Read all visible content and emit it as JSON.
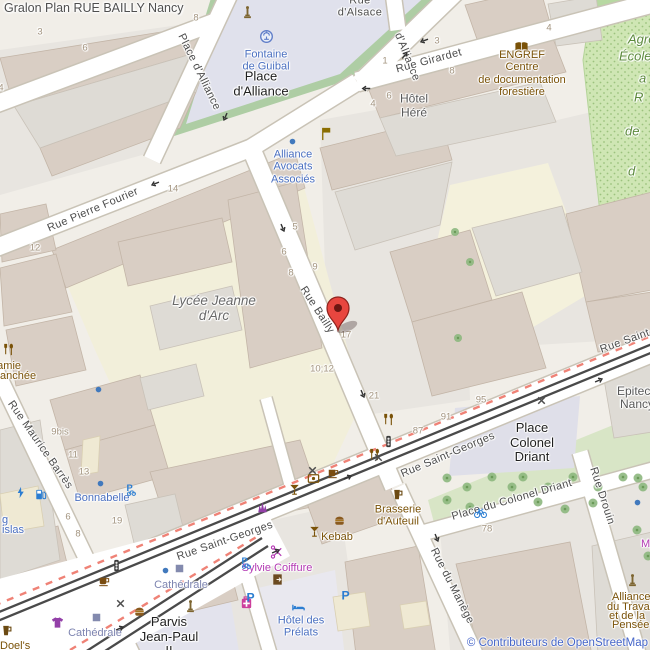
{
  "title": "Gralon Plan RUE BAILLY Nancy",
  "attribution": "© Contributeurs de OpenStreetMap",
  "colors": {
    "marker_red": "#e8463f",
    "street_label": "#4c4c4c",
    "poi_blue": "#4a6fc0",
    "poi_brown": "#7a5208",
    "shop_magenta": "#b339b3",
    "station_blue": "#7d84b0",
    "green_text": "#5c8a3c",
    "housenumber": "#a3947f",
    "attribution_blue": "#4565c8",
    "pedestrian_area": "#e0e1ec",
    "school_area": "#f2efda",
    "park_green": "#cfe6b4",
    "building_tan": "#d9cec4",
    "building_gray": "#dedbd5"
  },
  "marker": {
    "location": "Rue Bailly",
    "x": 338,
    "y": 330
  },
  "labels": [
    {
      "id": "street-place-dalliance",
      "t": "Place d'Alliance",
      "x": 199,
      "y": 72,
      "r": 64,
      "c": "st"
    },
    {
      "id": "street-dalliance",
      "t": "d'Alliance",
      "x": 407,
      "y": 57,
      "r": 68,
      "c": "st"
    },
    {
      "id": "street-rue-dalsace",
      "t": "Rue\nd'Alsace",
      "x": 360,
      "y": 7,
      "r": 0,
      "c": "st"
    },
    {
      "id": "street-rue-girardet",
      "t": "Rue Girardet",
      "x": 429,
      "y": 61,
      "r": -15,
      "c": "st"
    },
    {
      "id": "street-rue-pierre-fourier",
      "t": "Rue Pierre Fourier",
      "x": 93,
      "y": 210,
      "r": -23,
      "c": "st"
    },
    {
      "id": "street-rue-bailly",
      "t": "Rue Bailly",
      "x": 317,
      "y": 310,
      "r": 57,
      "c": "st"
    },
    {
      "id": "street-rue-saint-georges-1",
      "t": "Rue Saint-Georges",
      "x": 448,
      "y": 455,
      "r": -23,
      "c": "st"
    },
    {
      "id": "street-rue-saint-georges-2",
      "t": "Rue Saint-Georges",
      "x": 225,
      "y": 541,
      "r": -19,
      "c": "st"
    },
    {
      "id": "street-rue-saint-georges-3",
      "t": "Rue Saint-Georges",
      "x": 648,
      "y": 333,
      "r": -20,
      "c": "st"
    },
    {
      "id": "street-rue-maurice-barres",
      "t": "Rue Maurice Barrès",
      "x": 40,
      "y": 445,
      "r": 55,
      "c": "st"
    },
    {
      "id": "street-place-du-colonel-driant",
      "t": "Place du Colonel Driant",
      "x": 512,
      "y": 500,
      "r": -16,
      "c": "st"
    },
    {
      "id": "street-rue-drouin",
      "t": "Rue Drouin",
      "x": 602,
      "y": 496,
      "r": 72,
      "c": "st"
    },
    {
      "id": "street-rue-du-manege",
      "t": "Rue du Manège",
      "x": 452,
      "y": 586,
      "r": 63,
      "c": "st"
    },
    {
      "id": "place-dalliance-label",
      "t": "Place\nd'Alliance",
      "x": 261,
      "y": 84,
      "r": 0,
      "c": "place"
    },
    {
      "id": "place-colonel-driant-label",
      "t": "Place\nColonel\nDriant",
      "x": 532,
      "y": 443,
      "r": 0,
      "c": "place"
    },
    {
      "id": "parvis-jean-paul-label",
      "t": "Parvis\nJean-Paul\nII",
      "x": 169,
      "y": 637,
      "r": 0,
      "c": "place"
    },
    {
      "id": "poi-fontaine-de-guibal",
      "t": "Fontaine\nde Guibal",
      "x": 266,
      "y": 61,
      "r": 0,
      "c": "pblue"
    },
    {
      "id": "poi-alliance-avocats",
      "t": "Alliance\nAvocats\nAssociés",
      "x": 293,
      "y": 167,
      "r": 0,
      "c": "pblue"
    },
    {
      "id": "poi-bonnabelle",
      "t": "Bonnabelle",
      "x": 102,
      "y": 498,
      "r": 0,
      "c": "pblue"
    },
    {
      "id": "poi-hotel-des-prelats",
      "t": "Hôtel des\nPrélats",
      "x": 301,
      "y": 627,
      "r": 0,
      "c": "pblue"
    },
    {
      "id": "poi-parking-fragment-1",
      "t": "g",
      "x": 2,
      "y": 520,
      "r": 0,
      "c": "pblue",
      "a": "l"
    },
    {
      "id": "poi-parking-fragment-2",
      "t": "islas",
      "x": 2,
      "y": 530,
      "r": 0,
      "c": "pblue",
      "a": "l"
    },
    {
      "id": "station-cathedrale-1",
      "t": "Cathédrale",
      "x": 181,
      "y": 585,
      "r": 0,
      "c": "stat"
    },
    {
      "id": "station-cathedrale-2",
      "t": "Cathédrale",
      "x": 95,
      "y": 633,
      "r": 0,
      "c": "stat"
    },
    {
      "id": "poi-engref",
      "t": "ENGREF\nCentre\nde documentation\nforestière",
      "x": 522,
      "y": 74,
      "r": 0,
      "c": "pbrown"
    },
    {
      "id": "poi-brasserie-dauteuil",
      "t": "Brasserie\nd'Auteuil",
      "x": 398,
      "y": 516,
      "r": 0,
      "c": "pbrown"
    },
    {
      "id": "poi-kebab",
      "t": "Kebab",
      "x": 337,
      "y": 537,
      "r": 0,
      "c": "pbrown"
    },
    {
      "id": "poi-mamie-fragment-1",
      "t": "Mamie",
      "x": -12,
      "y": 366,
      "r": 0,
      "c": "pbrown",
      "a": "l"
    },
    {
      "id": "poi-mamie-fragment-2",
      "t": "anchée",
      "x": 0,
      "y": 376,
      "r": 0,
      "c": "pbrown",
      "a": "l"
    },
    {
      "id": "poi-alliance-travail-1",
      "t": "Alliance",
      "x": 612,
      "y": 597,
      "r": 0,
      "c": "pbrown",
      "a": "l"
    },
    {
      "id": "poi-alliance-travail-2",
      "t": "du Travail",
      "x": 607,
      "y": 607,
      "r": 0,
      "c": "pbrown",
      "a": "l"
    },
    {
      "id": "poi-alliance-travail-3",
      "t": "et de la",
      "x": 609,
      "y": 616,
      "r": 0,
      "c": "pbrown",
      "a": "l"
    },
    {
      "id": "poi-alliance-travail-4",
      "t": "Pensée",
      "x": 612,
      "y": 625,
      "r": 0,
      "c": "pbrown",
      "a": "l"
    },
    {
      "id": "poi-doels-fragment",
      "t": "Doel's",
      "x": 0,
      "y": 646,
      "r": 0,
      "c": "pbrown",
      "a": "l"
    },
    {
      "id": "poi-sylvie-coiffure",
      "t": "Sylvie Coiffure",
      "x": 277,
      "y": 568,
      "r": 0,
      "c": "pmag"
    },
    {
      "id": "poi-my-fragment",
      "t": "My",
      "x": 641,
      "y": 544,
      "r": 0,
      "c": "pmag",
      "a": "l"
    },
    {
      "id": "poi-lycee-jeanne-darc",
      "t": "Lycée Jeanne\nd'Arc",
      "x": 214,
      "y": 308,
      "r": 0,
      "c": "glabel"
    },
    {
      "id": "poi-hotel-here",
      "t": "Hôtel\nHéré",
      "x": 414,
      "y": 106,
      "r": 0,
      "c": "bldg"
    },
    {
      "id": "poi-epitech-1",
      "t": "Epitech",
      "x": 617,
      "y": 392,
      "r": 0,
      "c": "bldg",
      "a": "l"
    },
    {
      "id": "poi-epitech-2",
      "t": "Nancy",
      "x": 620,
      "y": 405,
      "r": 0,
      "c": "bldg",
      "a": "l"
    },
    {
      "id": "green-fragment-1",
      "t": "Agro",
      "x": 628,
      "y": 40,
      "r": 0,
      "c": "green",
      "a": "l"
    },
    {
      "id": "green-fragment-2",
      "t": "École",
      "x": 619,
      "y": 57,
      "r": 0,
      "c": "green",
      "a": "l"
    },
    {
      "id": "green-fragment-3",
      "t": "a",
      "x": 639,
      "y": 79,
      "r": 0,
      "c": "green",
      "a": "l"
    },
    {
      "id": "green-fragment-4",
      "t": "R",
      "x": 634,
      "y": 98,
      "r": 0,
      "c": "green",
      "a": "l"
    },
    {
      "id": "green-fragment-5",
      "t": "de",
      "x": 625,
      "y": 132,
      "r": 0,
      "c": "green",
      "a": "l"
    },
    {
      "id": "green-fragment-6",
      "t": "d",
      "x": 628,
      "y": 172,
      "r": 0,
      "c": "green",
      "a": "l"
    }
  ],
  "housenumbers": [
    {
      "t": "3",
      "x": 40,
      "y": 33
    },
    {
      "t": "8",
      "x": 196,
      "y": 19
    },
    {
      "t": "6",
      "x": 85,
      "y": 49
    },
    {
      "t": "4",
      "x": 1,
      "y": 89
    },
    {
      "t": "1",
      "x": 385,
      "y": 62
    },
    {
      "t": "3",
      "x": 437,
      "y": 42
    },
    {
      "t": "8",
      "x": 452,
      "y": 72
    },
    {
      "t": "4",
      "x": 549,
      "y": 29
    },
    {
      "t": "4",
      "x": 373,
      "y": 105
    },
    {
      "t": "6",
      "x": 389,
      "y": 97
    },
    {
      "t": "5",
      "x": 295,
      "y": 228
    },
    {
      "t": "6",
      "x": 284,
      "y": 253
    },
    {
      "t": "8",
      "x": 291,
      "y": 274
    },
    {
      "t": "9",
      "x": 315,
      "y": 268
    },
    {
      "t": "17",
      "x": 346,
      "y": 336
    },
    {
      "t": "10;12",
      "x": 322,
      "y": 370
    },
    {
      "t": "21",
      "x": 374,
      "y": 397
    },
    {
      "t": "87",
      "x": 418,
      "y": 432
    },
    {
      "t": "91",
      "x": 446,
      "y": 418
    },
    {
      "t": "95",
      "x": 481,
      "y": 401
    },
    {
      "t": "12",
      "x": 35,
      "y": 249
    },
    {
      "t": "14",
      "x": 173,
      "y": 190
    },
    {
      "t": "9bis",
      "x": 60,
      "y": 433
    },
    {
      "t": "11",
      "x": 73,
      "y": 456
    },
    {
      "t": "13",
      "x": 84,
      "y": 473
    },
    {
      "t": "6",
      "x": 68,
      "y": 518
    },
    {
      "t": "8",
      "x": 78,
      "y": 535
    },
    {
      "t": "19",
      "x": 117,
      "y": 522
    },
    {
      "t": "78",
      "x": 487,
      "y": 530
    }
  ],
  "pois": [
    {
      "i": "fountain",
      "x": 266,
      "y": 36
    },
    {
      "i": "monument",
      "x": 247,
      "y": 12
    },
    {
      "i": "flag",
      "x": 326,
      "y": 133
    },
    {
      "i": "blue-dot",
      "x": 292,
      "y": 141
    },
    {
      "i": "book",
      "x": 521,
      "y": 46
    },
    {
      "i": "blue-dot",
      "x": 98,
      "y": 389
    },
    {
      "i": "blue-dot",
      "x": 100,
      "y": 483
    },
    {
      "i": "blue-dot",
      "x": 637,
      "y": 502
    },
    {
      "i": "blue-dot",
      "x": 165,
      "y": 570
    },
    {
      "i": "restaurant",
      "x": 8,
      "y": 349
    },
    {
      "i": "restaurant",
      "x": 388,
      "y": 419
    },
    {
      "i": "restaurant",
      "x": 374,
      "y": 454
    },
    {
      "i": "traffic-light",
      "x": 388,
      "y": 441
    },
    {
      "i": "traffic-light",
      "x": 116,
      "y": 565
    },
    {
      "i": "cafe-cup",
      "x": 332,
      "y": 472
    },
    {
      "i": "cafe-cup",
      "x": 103,
      "y": 580
    },
    {
      "i": "artwork-frame",
      "x": 313,
      "y": 478
    },
    {
      "i": "cocktail",
      "x": 294,
      "y": 489
    },
    {
      "i": "cocktail",
      "x": 314,
      "y": 531
    },
    {
      "i": "burger",
      "x": 339,
      "y": 520
    },
    {
      "i": "burger",
      "x": 139,
      "y": 611
    },
    {
      "i": "tshirt",
      "x": 57,
      "y": 622
    },
    {
      "i": "pharmacy",
      "x": 246,
      "y": 602
    },
    {
      "i": "beer-mug",
      "x": 6,
      "y": 630
    },
    {
      "i": "beer-mug",
      "x": 397,
      "y": 494
    },
    {
      "i": "monument",
      "x": 190,
      "y": 606
    },
    {
      "i": "monument",
      "x": 632,
      "y": 580
    },
    {
      "i": "tram-stop",
      "x": 179,
      "y": 568
    },
    {
      "i": "tram-stop",
      "x": 96,
      "y": 617
    },
    {
      "i": "parking",
      "x": 250,
      "y": 597
    },
    {
      "i": "parking",
      "x": 345,
      "y": 595
    },
    {
      "i": "bicycle-parking",
      "x": 245,
      "y": 562
    },
    {
      "i": "bicycle-parking",
      "x": 130,
      "y": 489
    },
    {
      "i": "charging-station",
      "x": 20,
      "y": 492
    },
    {
      "i": "fuel",
      "x": 40,
      "y": 494
    },
    {
      "i": "bicycle-rental",
      "x": 480,
      "y": 512
    },
    {
      "i": "scissors",
      "x": 277,
      "y": 552
    },
    {
      "i": "door",
      "x": 277,
      "y": 579
    },
    {
      "i": "bed",
      "x": 298,
      "y": 607
    },
    {
      "i": "cosmetics",
      "x": 262,
      "y": 507
    },
    {
      "i": "crossing",
      "x": 312,
      "y": 470
    },
    {
      "i": "crossing",
      "x": 378,
      "y": 457
    },
    {
      "i": "crossing",
      "x": 541,
      "y": 400
    },
    {
      "i": "crossing",
      "x": 120,
      "y": 603
    },
    {
      "i": "oneway-arrow",
      "x": 225,
      "y": 116,
      "r": 114
    },
    {
      "i": "oneway-arrow",
      "x": 366,
      "y": 88,
      "r": 180
    },
    {
      "i": "oneway-arrow",
      "x": 404,
      "y": 55,
      "r": -53
    },
    {
      "i": "oneway-arrow",
      "x": 282,
      "y": 227,
      "r": 67
    },
    {
      "i": "oneway-arrow",
      "x": 362,
      "y": 393,
      "r": 67
    },
    {
      "i": "oneway-arrow",
      "x": 347,
      "y": 477,
      "r": -23
    },
    {
      "i": "oneway-arrow",
      "x": 598,
      "y": 380,
      "r": -23
    },
    {
      "i": "oneway-arrow",
      "x": 275,
      "y": 551,
      "r": -23
    },
    {
      "i": "oneway-arrow",
      "x": 119,
      "y": 628,
      "r": -23
    },
    {
      "i": "oneway-arrow",
      "x": 436,
      "y": 537,
      "r": 68
    },
    {
      "i": "oneway-arrow",
      "x": 155,
      "y": 183,
      "r": 158
    },
    {
      "i": "oneway-arrow",
      "x": 424,
      "y": 40,
      "r": 160
    }
  ]
}
